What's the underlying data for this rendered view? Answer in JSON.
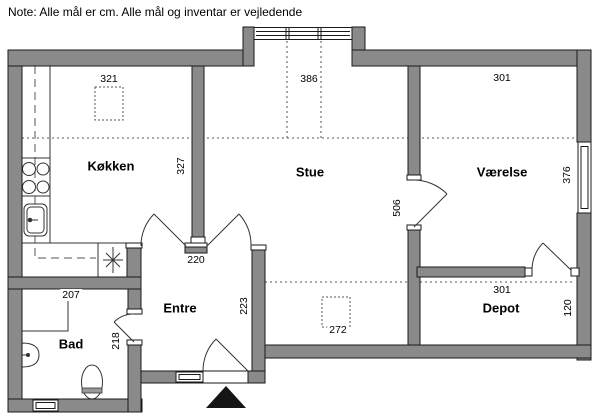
{
  "note": "Note: Alle mål er cm. Alle mål og inventar er vejledende",
  "rooms": {
    "kitchen": {
      "label": "Køkken",
      "measure_horizontal": "321",
      "measure_vertical": "327"
    },
    "living_room": {
      "label": "Stue",
      "measure_horizontal": "386",
      "measure_vertical": "506",
      "floor_marker": "272"
    },
    "bedroom": {
      "label": "Værelse",
      "measure_horizontal": "301",
      "measure_vertical": "376"
    },
    "entry": {
      "label": "Entre",
      "measure_horizontal": "220",
      "measure_vertical": "223"
    },
    "bathroom": {
      "label": "Bad",
      "measure_horizontal": "207",
      "measure_vertical": "218"
    },
    "storage": {
      "label": "Depot",
      "measure_horizontal": "301",
      "measure_vertical": "120"
    }
  },
  "colors": {
    "wall_fill": "#8a8a8a",
    "wall_outline": "#1a1a1a",
    "thin_line": "#333333",
    "text": "#000000",
    "background": "#ffffff",
    "entrance_marker": "#151515"
  },
  "icons": {
    "stove-icon": "four burner circles",
    "kitchen-sink-icon": "rounded rectangle basin with tap",
    "appliance-star-icon": "asterisk symbol",
    "shower-icon": "open thin rectangle",
    "hand-basin-icon": "half oval on wall",
    "toilet-icon": "oval with seat band",
    "entrance-arrow-icon": "filled black triangle",
    "window-icon": "double line frame in wall",
    "door-icon": "quarter circle swing arc"
  }
}
